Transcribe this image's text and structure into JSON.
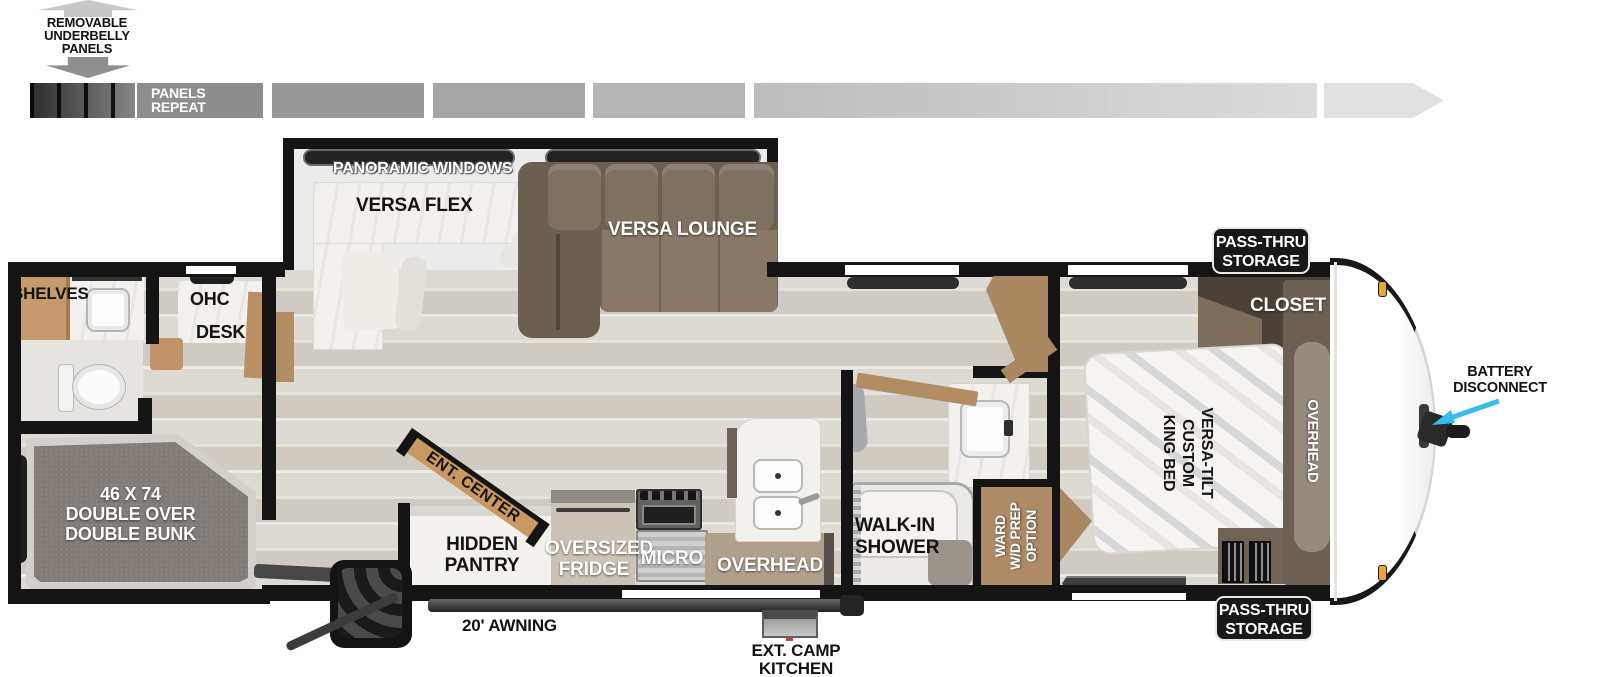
{
  "underbelly": {
    "l1": "REMOVABLE",
    "l2": "UNDERBELLY",
    "l3": "PANELS",
    "repeat_l1": "PANELS",
    "repeat_l2": "REPEAT"
  },
  "rear_bath": {
    "shelves": "SHELVES",
    "ohc": "OHC",
    "desk": "DESK"
  },
  "bunk": {
    "l1": "46 X 74",
    "l2": "DOUBLE OVER",
    "l3": "DOUBLE BUNK"
  },
  "living": {
    "panoramic": "PANORAMIC WINDOWS",
    "versa_flex": "VERSA FLEX",
    "versa_lounge": "VERSA LOUNGE",
    "ent_center": "ENT. CENTER"
  },
  "kitchen": {
    "pantry_l1": "HIDDEN",
    "pantry_l2": "PANTRY",
    "fridge_l1": "OVERSIZED",
    "fridge_l2": "FRIDGE",
    "micro": "MICRO",
    "overhead": "OVERHEAD"
  },
  "bath": {
    "shower_l1": "WALK-IN",
    "shower_l2": "SHOWER",
    "ward_l1": "WARD",
    "ward_l2": "W/D PREP",
    "ward_l3": "OPTION"
  },
  "bedroom": {
    "closet": "CLOSET",
    "bed_l1": "VERSA-TILT",
    "bed_l2": "CUSTOM",
    "bed_l3": "KING BED",
    "overhead": "OVERHEAD"
  },
  "badges": {
    "top_l1": "PASS-THRU",
    "top_l2": "STORAGE",
    "bottom_l1": "PASS-THRU",
    "bottom_l2": "STORAGE"
  },
  "exterior": {
    "awning": "20' AWNING",
    "camp_l1": "EXT. CAMP",
    "camp_l2": "KITCHEN",
    "battery_l1": "BATTERY",
    "battery_l2": "DISCONNECT"
  },
  "colors": {
    "wall": "#141414",
    "accent_arrow": "#35bdec",
    "cabinet_tan": "#b1a08c",
    "door_tan": "#a98760",
    "sofa_brown": "#7b6f5d",
    "badge_bg": "#181818",
    "marker_light": "#eaa43e"
  }
}
